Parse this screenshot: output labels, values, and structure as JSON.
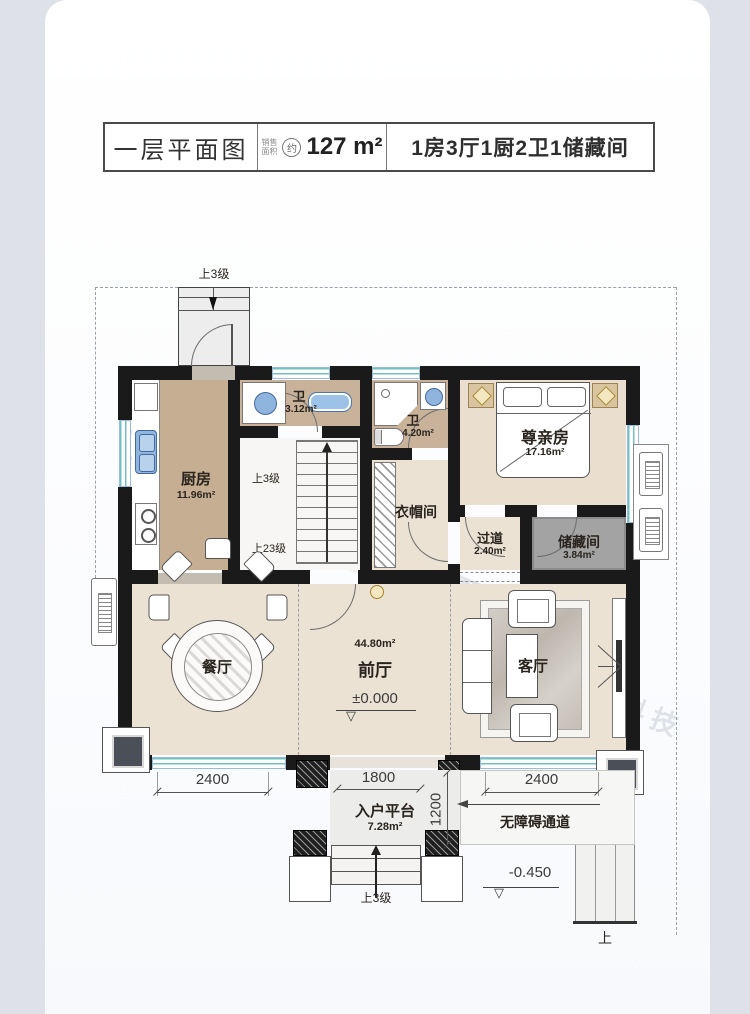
{
  "header": {
    "title": "一层平面图",
    "sale_label_top": "销售",
    "sale_label_bottom": "面积",
    "approx": "约",
    "area": "127 m²",
    "spec": "1房3厅1厨2卫1储藏间"
  },
  "rooms": {
    "kitchen": {
      "name": "厨房",
      "area": "11.96m²"
    },
    "bath1": {
      "name": "卫",
      "area": "3.12m²"
    },
    "bath2": {
      "name": "卫",
      "area": "4.20m²"
    },
    "elder": {
      "name": "尊亲房",
      "area": "17.16m²"
    },
    "cloakroom": {
      "name": "衣帽间"
    },
    "corridor": {
      "name": "过道",
      "area": "2.40m²"
    },
    "storage": {
      "name": "储藏间",
      "area": "3.84m²"
    },
    "dining": {
      "name": "餐厅"
    },
    "hall": {
      "name": "前厅",
      "area": "44.80m²",
      "level": "±0.000"
    },
    "living": {
      "name": "客厅"
    },
    "platform": {
      "name": "入户平台",
      "area": "7.28m²"
    }
  },
  "annotations": {
    "top_steps": "上3级",
    "stair_up_3": "上3级",
    "stair_up_23": "上23级",
    "entry_steps": "上3级",
    "barrier_free": "无障碍通道",
    "outdoor_level": "-0.450",
    "ramp_up": "上",
    "level_mark": "▽"
  },
  "dimensions": {
    "dining_width": "2400",
    "entry_width": "1800",
    "living_width": "2400",
    "platform_depth": "1200"
  },
  "watermark": {
    "cn": "美置乡墅科技",
    "en": "MEIZHI VILLA TECHNOLOGY"
  },
  "colors": {
    "page_bg": "#dee2e8",
    "wall": "#1a1a1a",
    "floor_tan": "#c6ae92",
    "floor_beige": "#ebe2d4",
    "floor_bedroom": "#eadfce",
    "floor_storage": "#a3a3a3",
    "window_teal": "#6fc2bd",
    "accent_gold": "#a5852c",
    "fixture_blue": "#8fb4dd",
    "watermark": "#b9c1ca"
  }
}
